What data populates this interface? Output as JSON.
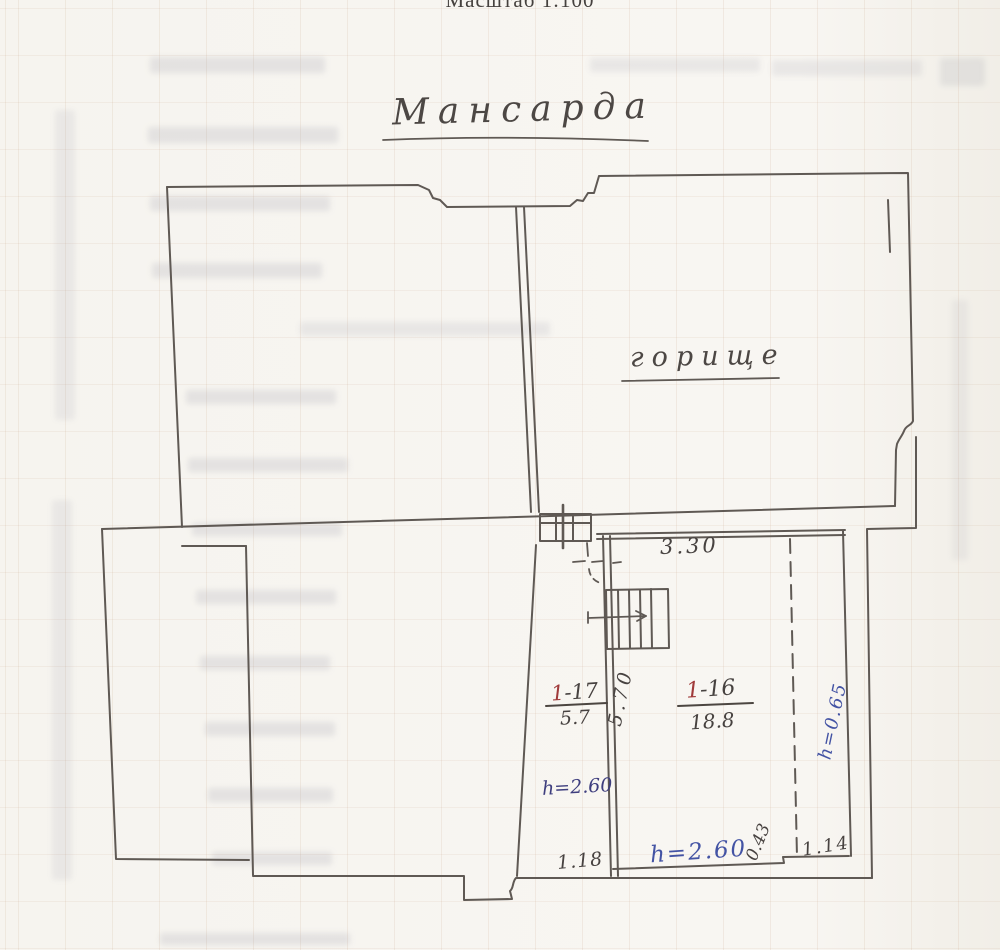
{
  "page": {
    "scale_label": "Масштаб 1:100",
    "title": "Мансарда"
  },
  "plan": {
    "attic_label": "горище",
    "dim_top_width": "3.30",
    "room17": {
      "prefix": "1",
      "rest": "-17",
      "area": "5.7"
    },
    "room16": {
      "prefix": "1",
      "rest": "-16",
      "area": "18.8"
    },
    "dim_corridor_length": "5.70",
    "h_corridor": "h=2.60",
    "dim_door": "1.18",
    "h_room": "h=2.60",
    "dim_step_width": "0.43",
    "dim_step_length": "1.14",
    "h_eaves": "h=0.65"
  },
  "colors": {
    "pencil": "#5f5954",
    "ink_blue": "#4353a4",
    "ink_purple": "#3e3e7e",
    "ink_red": "#a03a3a"
  }
}
